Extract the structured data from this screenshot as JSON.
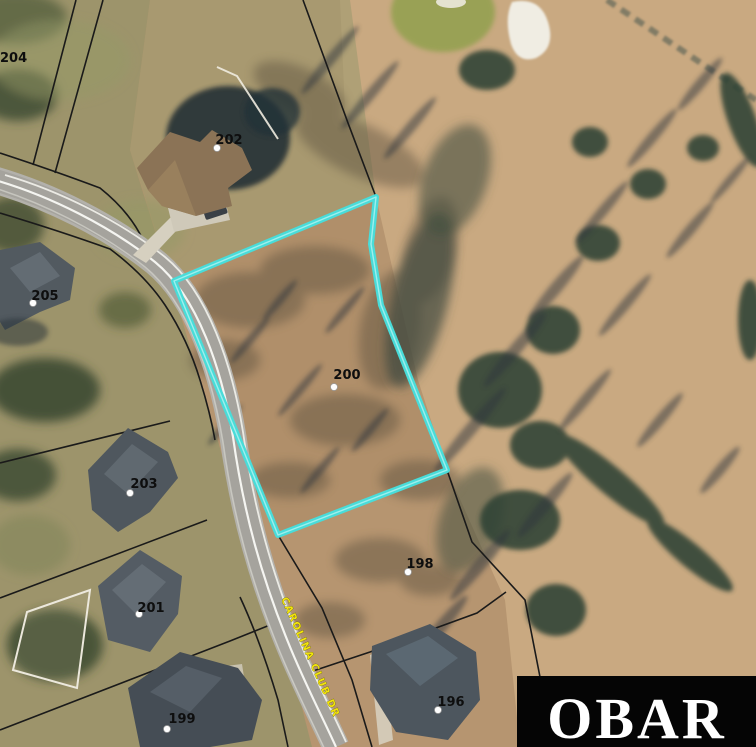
{
  "map": {
    "type": "aerial-parcel-map",
    "road": {
      "label": "CAROLINA CLUB DR"
    },
    "parcel_highlight": {
      "lot": "200",
      "outline_color": "#49dcd9"
    },
    "lots": [
      {
        "id": "204",
        "label": "204"
      },
      {
        "id": "202",
        "label": "202"
      },
      {
        "id": "205",
        "label": "205"
      },
      {
        "id": "203",
        "label": "203"
      },
      {
        "id": "201",
        "label": "201"
      },
      {
        "id": "199",
        "label": "199"
      },
      {
        "id": "200",
        "label": "200"
      },
      {
        "id": "198",
        "label": "198"
      },
      {
        "id": "196",
        "label": "196"
      }
    ]
  },
  "logo": {
    "text": "OBAR",
    "background": "#050505",
    "text_color": "#ffffff"
  },
  "colors": {
    "lot_label": "#0e0e0e",
    "road_label": "#f2e40a",
    "parcel_outline": "#49dcd9",
    "boundary_line": "#1a1a1a"
  }
}
